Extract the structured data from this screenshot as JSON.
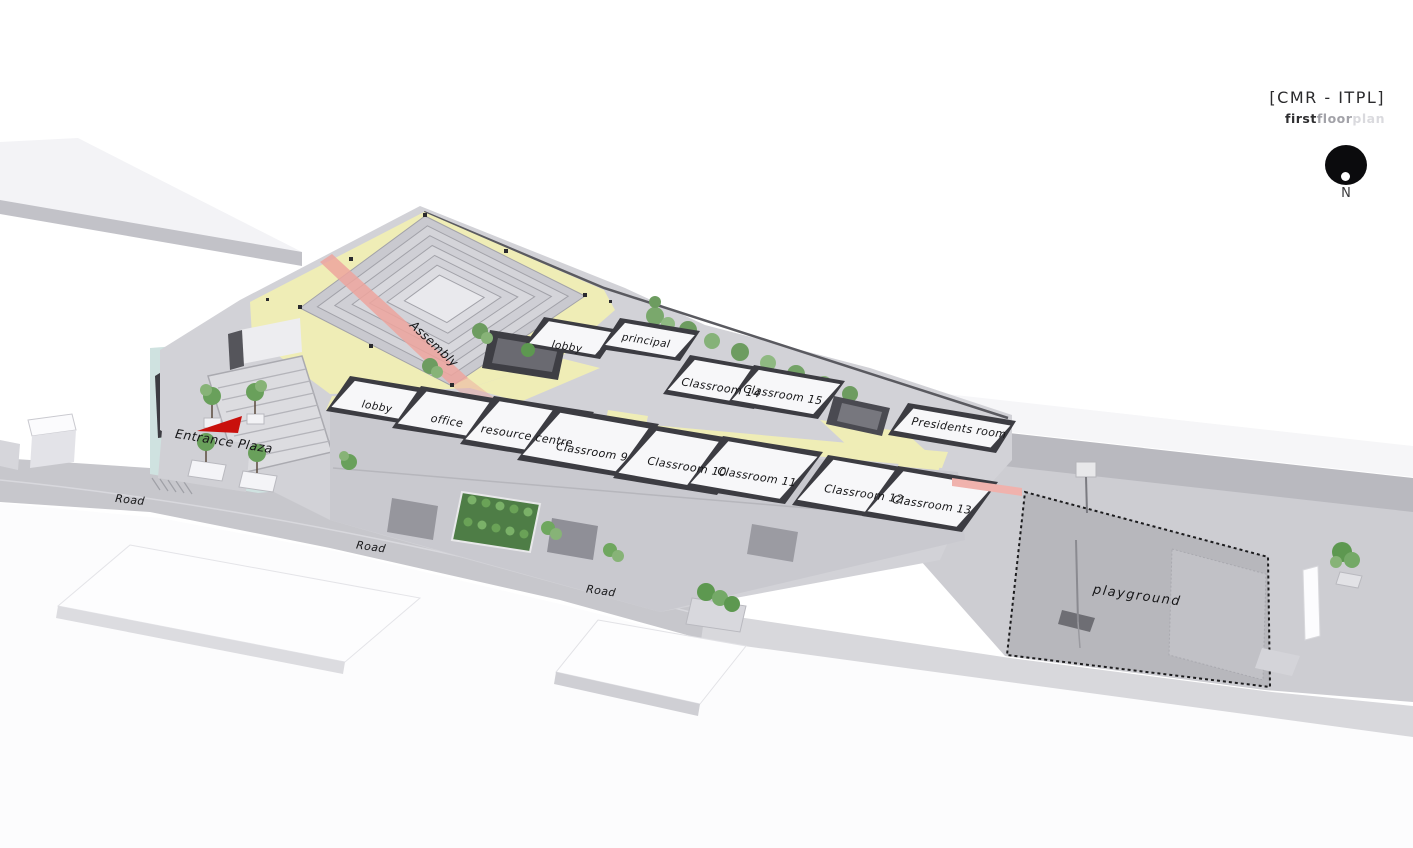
{
  "header": {
    "title": "[CMR - ITPL]",
    "subtitle": {
      "first": "first",
      "floor": "floor",
      "plan": "plan"
    },
    "north_label": "N"
  },
  "rooms": {
    "assembly": {
      "label": "Assembly"
    },
    "lobby_upper": {
      "label": "lobby"
    },
    "principal": {
      "label": "principal"
    },
    "classroom14": {
      "label": "Classroom 14"
    },
    "classroom15": {
      "label": "Classroom 15"
    },
    "presidents_room": {
      "label": "Presidents room"
    },
    "lobby_front": {
      "label": "lobby"
    },
    "office": {
      "label": "office"
    },
    "resource_centre": {
      "label": "resource centre"
    },
    "classroom9": {
      "label": "Classroom 9"
    },
    "classroom10": {
      "label": "Classroom 10"
    },
    "classroom11": {
      "label": "Classroom 11"
    },
    "classroom12": {
      "label": "Classroom 12"
    },
    "classroom13": {
      "label": "Classroom 13"
    }
  },
  "site": {
    "entrance_plaza": {
      "label": "Entrance Plaza"
    },
    "road_west": {
      "label": "Road"
    },
    "road_middle": {
      "label": "Road"
    },
    "road_east": {
      "label": "Road"
    },
    "playground": {
      "label": "playground"
    }
  },
  "colors": {
    "corridor_yellow": "#efedb6",
    "plaza_blue": "#cfe2e0",
    "arrow_red": "#c9100c",
    "carpet_pink": "#eda59e",
    "playground_gray": "#b7b7bc",
    "wall_dark": "#3c3c42",
    "tree_green": "#69a05b"
  }
}
